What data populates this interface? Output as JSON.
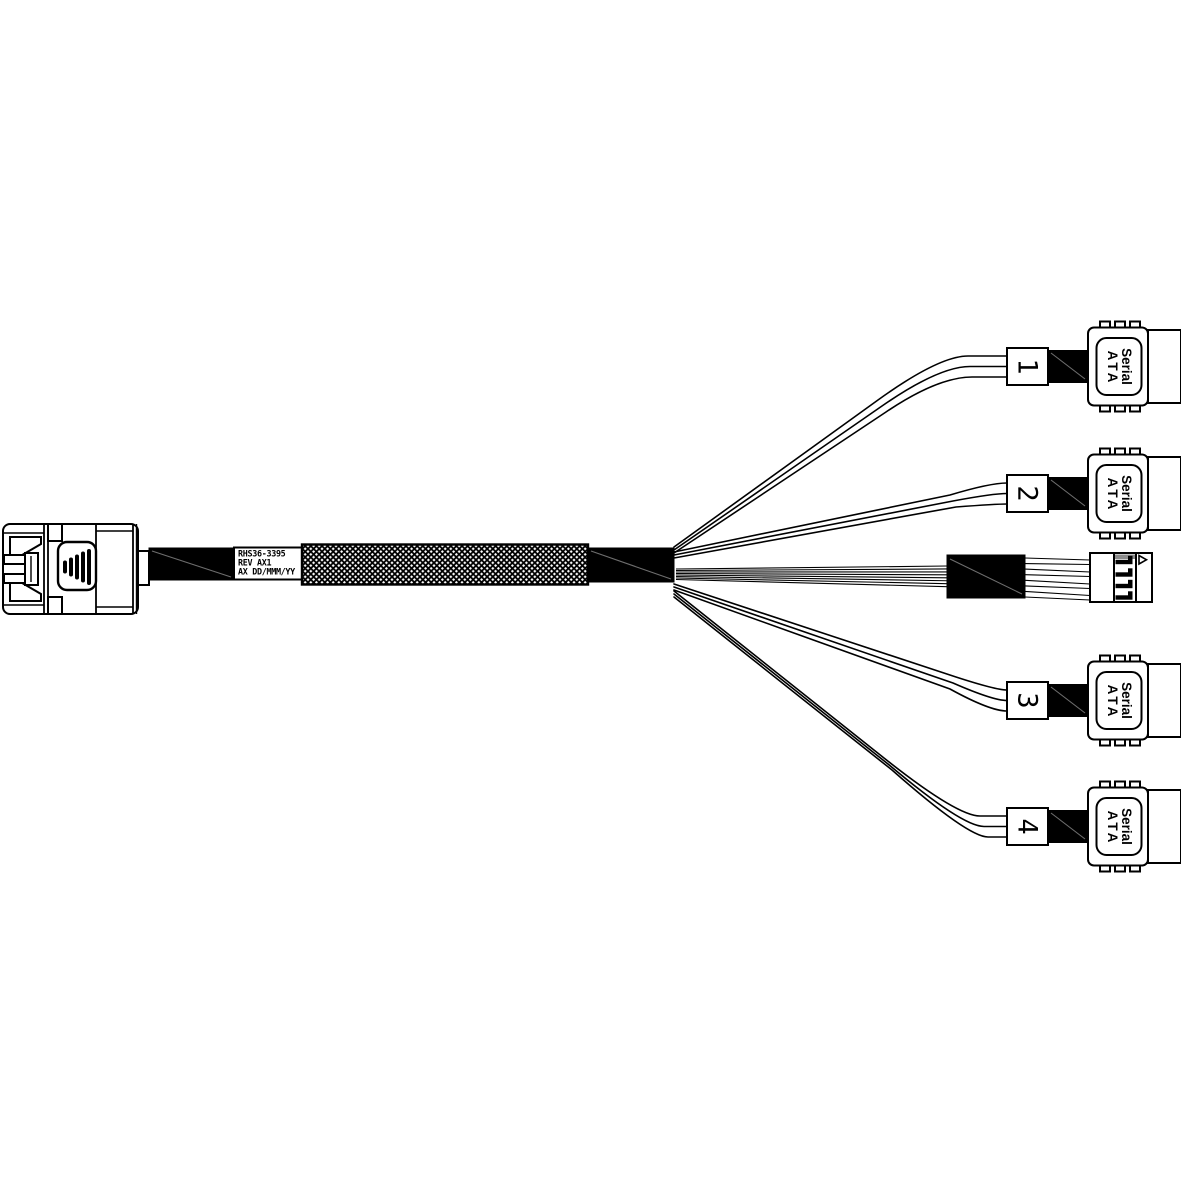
{
  "page": {
    "background_color": "#ffffff",
    "line_color": "#000000",
    "heatshrink_color": "#000000"
  },
  "cable_label": {
    "line1": "RHS36-3395",
    "line2": "REV AX1",
    "line3": "AX DD/MMM/YY"
  },
  "sata_connector_text": {
    "line1": "Serial",
    "line2": "ATA"
  },
  "branches": [
    {
      "number": "1"
    },
    {
      "number": "2"
    },
    {
      "number": "3"
    },
    {
      "number": "4"
    }
  ],
  "icons": {
    "left_connector": "mini-sas-plug-icon",
    "right_connectors": "sata-plug-icon",
    "middle_connector": "sideband-header-icon",
    "pin1_marker": "triangle-marker-icon"
  }
}
